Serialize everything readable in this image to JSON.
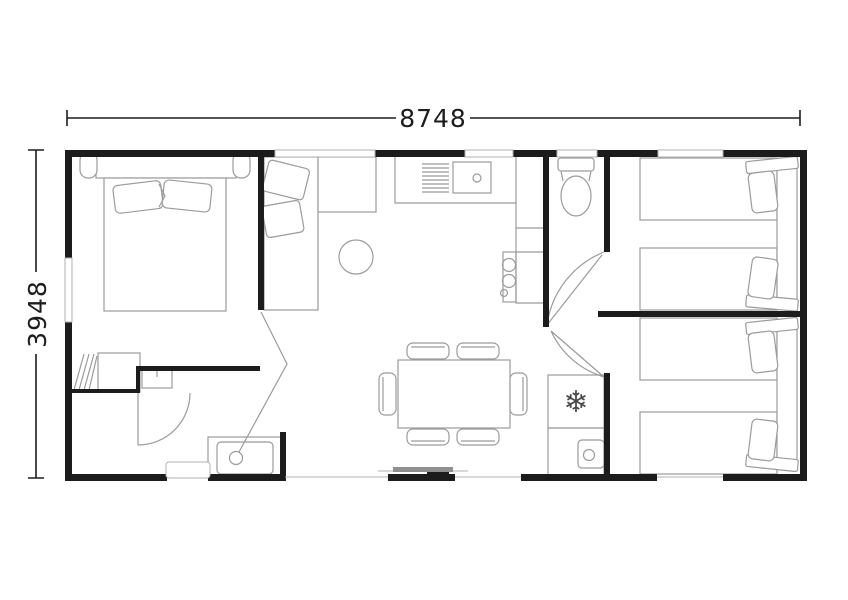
{
  "dimensions": {
    "width_label": "8748",
    "height_label": "3948"
  },
  "icons": {
    "snowflake": "❄"
  },
  "colors": {
    "background": "#ffffff",
    "wall": "#1c1c1c",
    "furniture": "#9b9b9b",
    "frame": "#b2b2b2",
    "door": "#8f8f8f",
    "dim": "#1d1d1b",
    "snowflake": "#4a4a4a"
  }
}
